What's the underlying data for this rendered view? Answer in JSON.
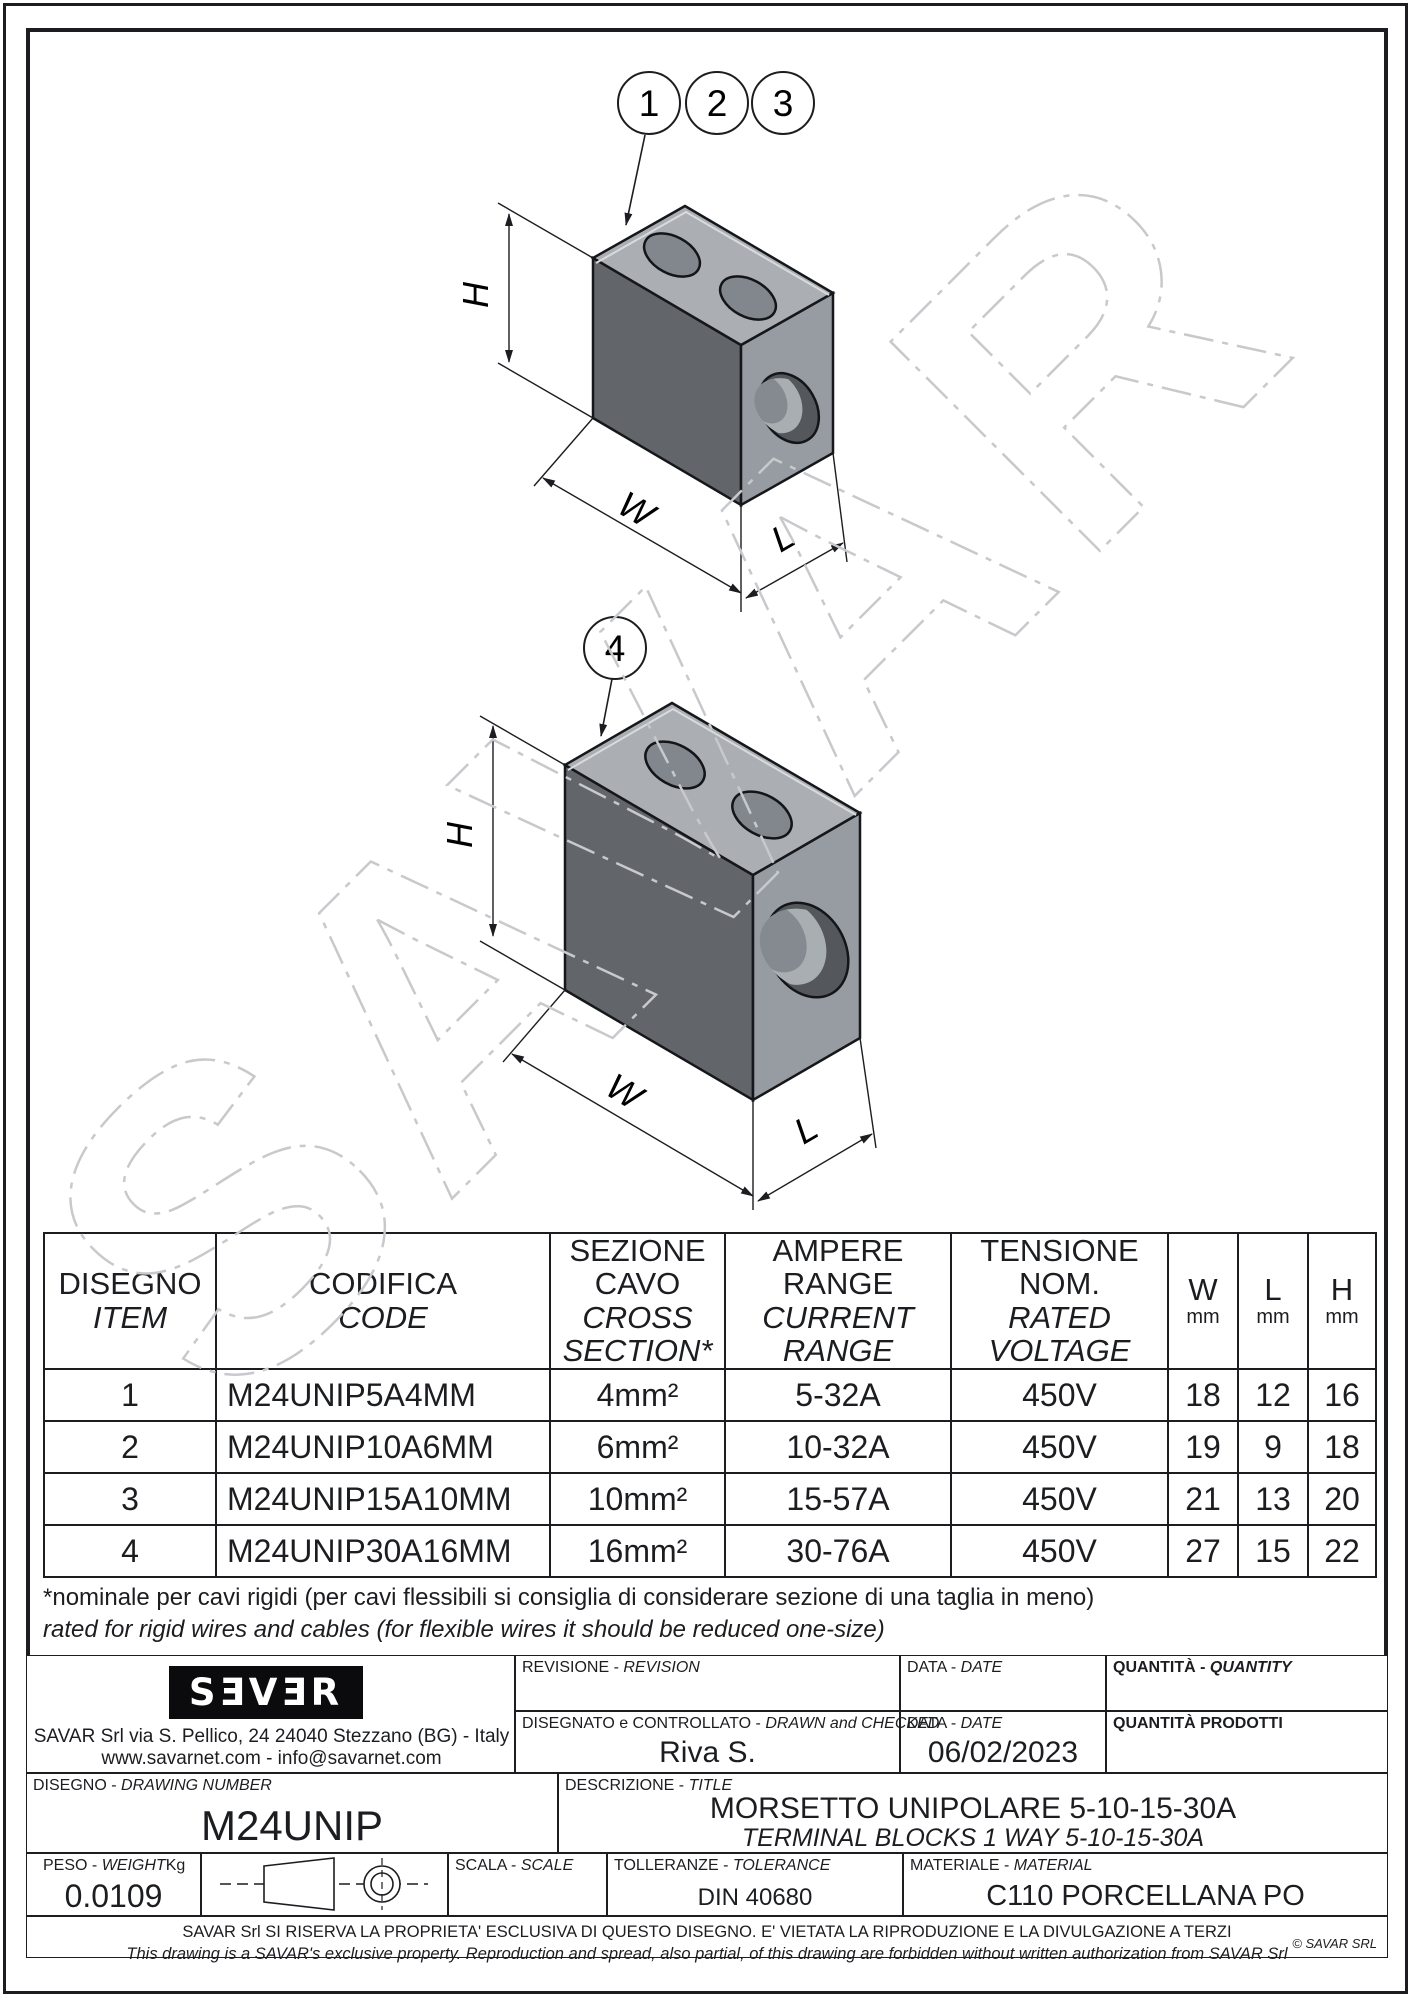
{
  "drawing": {
    "balloons": [
      "1",
      "2",
      "3"
    ],
    "balloon4": "4",
    "dims": {
      "h": "H",
      "w": "W",
      "l": "L"
    },
    "watermark": "SAVAR"
  },
  "table": {
    "headers": {
      "item": {
        "it": "DISEGNO",
        "en": "ITEM"
      },
      "code": {
        "it": "CODIFICA",
        "en": "CODE"
      },
      "section": {
        "it1": "SEZIONE",
        "it2": "CAVO",
        "en1": "CROSS",
        "en2": "SECTION*"
      },
      "ampere": {
        "it1": "AMPERE",
        "it2": "RANGE",
        "en1": "CURRENT",
        "en2": "RANGE"
      },
      "voltage": {
        "it1": "TENSIONE",
        "it2": "NOM.",
        "en1": "RATED",
        "en2": "VOLTAGE"
      },
      "w": {
        "label": "W",
        "unit": "mm"
      },
      "l": {
        "label": "L",
        "unit": "mm"
      },
      "h": {
        "label": "H",
        "unit": "mm"
      }
    },
    "rows": [
      {
        "item": "1",
        "code": "M24UNIP5A4MM",
        "section": "4mm²",
        "ampere": "5-32A",
        "voltage": "450V",
        "w": "18",
        "l": "12",
        "h": "16"
      },
      {
        "item": "2",
        "code": "M24UNIP10A6MM",
        "section": "6mm²",
        "ampere": "10-32A",
        "voltage": "450V",
        "w": "19",
        "l": "9",
        "h": "18"
      },
      {
        "item": "3",
        "code": "M24UNIP15A10MM",
        "section": "10mm²",
        "ampere": "15-57A",
        "voltage": "450V",
        "w": "21",
        "l": "13",
        "h": "20"
      },
      {
        "item": "4",
        "code": "M24UNIP30A16MM",
        "section": "16mm²",
        "ampere": "30-76A",
        "voltage": "450V",
        "w": "27",
        "l": "15",
        "h": "22"
      }
    ]
  },
  "footnote": {
    "line1": "*nominale per cavi rigidi (per cavi flessibili si consiglia di considerare sezione di una taglia in meno)",
    "line2": "rated for rigid wires and cables (for flexible wires it should be reduced one-size)"
  },
  "titleblock": {
    "sep": "-",
    "logo_text": "SƎVƎR",
    "company_line1": "SAVAR Srl via S. Pellico, 24  24040 Stezzano (BG) - Italy",
    "company_line2": "www.savarnet.com  -  info@savarnet.com",
    "revision_label": {
      "it": "REVISIONE",
      "en": "REVISION"
    },
    "date_label": {
      "it": "DATA",
      "en": "DATE"
    },
    "quantity_label": {
      "it": "QUANTITÀ",
      "en": "QUANTITY"
    },
    "drawn_label": {
      "it": "DISEGNATO e CONTROLLATO",
      "en": "DRAWN and CHECKED"
    },
    "drawn_value": "Riva S.",
    "date_value": "06/02/2023",
    "quantity_prod_label": "QUANTITÀ  PRODOTTI",
    "drawing_number_label": {
      "it": "DISEGNO",
      "en": "DRAWING NUMBER"
    },
    "drawing_number": "M24UNIP",
    "description_label": {
      "it": "DESCRIZIONE",
      "en": "TITLE"
    },
    "description_it": "MORSETTO UNIPOLARE 5-10-15-30A",
    "description_en": "TERMINAL BLOCKS 1 WAY 5-10-15-30A",
    "weight_label": {
      "it": "PESO",
      "en": "WEIGHT"
    },
    "weight_unit": "Kg",
    "weight_value": "0.0109",
    "scale_label": {
      "it": "SCALA",
      "en": "SCALE"
    },
    "tolerance_label": {
      "it": "TOLLERANZE",
      "en": "TOLERANCE"
    },
    "tolerance_value": "DIN 40680",
    "material_label": {
      "it": "MATERIALE",
      "en": "MATERIAL"
    },
    "material_value": "C110 PORCELLANA PO"
  },
  "disclaimer": {
    "line1": "SAVAR Srl SI RISERVA LA PROPRIETA' ESCLUSIVA DI QUESTO DISEGNO. E' VIETATA LA RIPRODUZIONE E LA DIVULGAZIONE A TERZI",
    "line2": "This drawing is a SAVAR's exclusive property. Reproduction and spread, also partial, of this drawing are forbidden without written authorization from SAVAR Srl",
    "copyright": "© SAVAR SRL"
  }
}
